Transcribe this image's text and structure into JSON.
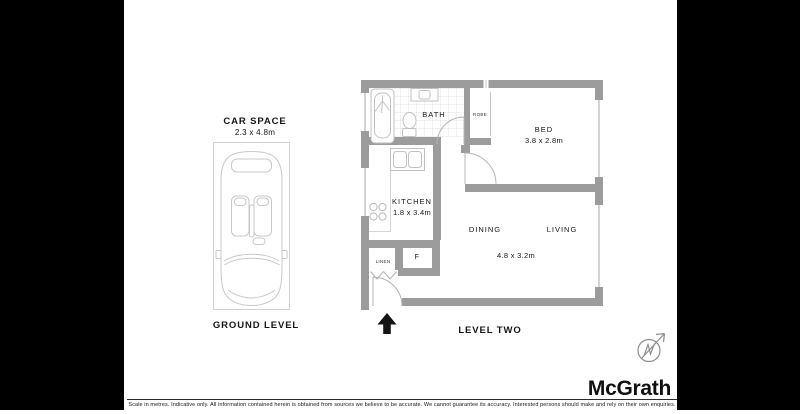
{
  "colors": {
    "wall": "#9c9c9c",
    "fixture_stroke": "#c4c4c4",
    "tile_line": "#e3e3e3",
    "text": "#161616",
    "letterbox": "#000000",
    "entry_arrow": "#151515"
  },
  "ground_level": {
    "title": "CAR SPACE",
    "dimensions": "2.3 x 4.8m",
    "caption": "GROUND LEVEL"
  },
  "level_two": {
    "caption": "LEVEL TWO",
    "bath": {
      "label": "BATH"
    },
    "robe": {
      "label": "ROBE"
    },
    "bed": {
      "label": "BED",
      "dimensions": "3.8 x 2.8m"
    },
    "kitchen": {
      "label": "KITCHEN",
      "dimensions": "1.8 x 3.4m"
    },
    "dining": {
      "label": "DINING"
    },
    "living": {
      "label": "LIVING"
    },
    "living_dining_dimensions": "4.8 x 3.2m",
    "linen": {
      "label": "LINEN"
    },
    "fridge": {
      "label": "F"
    }
  },
  "icons": {
    "compass": "compass-north-icon",
    "entry": "entry-arrow-icon"
  },
  "branding": {
    "logo_text": "McGrath"
  },
  "footer": {
    "disclaimer": "Scale in metres. Indicative only. All information contained herein is obtained from sources we believe to be accurate. We cannot guarantee its accuracy. Interested persons should make and rely on their own enquiries."
  }
}
